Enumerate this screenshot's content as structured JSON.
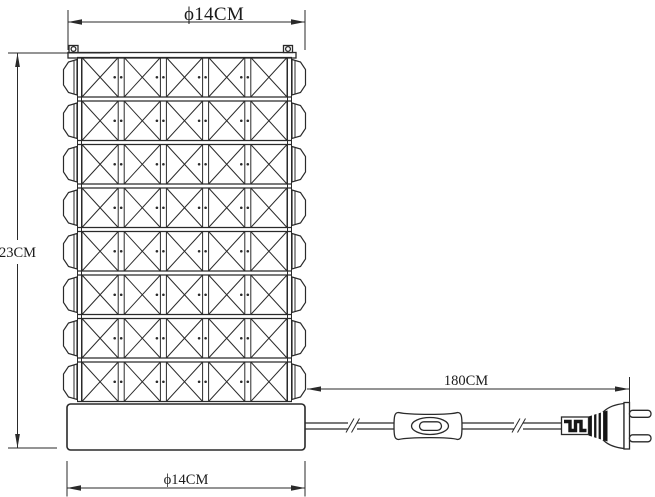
{
  "drawing": {
    "background_color": "#ffffff",
    "line_color": "#2a2a2a",
    "dimensions": {
      "top_diameter": {
        "label": "ϕ14CM"
      },
      "height": {
        "label": "23CM"
      },
      "cord_length": {
        "label": "180CM"
      },
      "base_diameter": {
        "label": "ϕ14CM"
      }
    },
    "lamp": {
      "grid_rows": 8,
      "grid_columns": 5
    }
  }
}
